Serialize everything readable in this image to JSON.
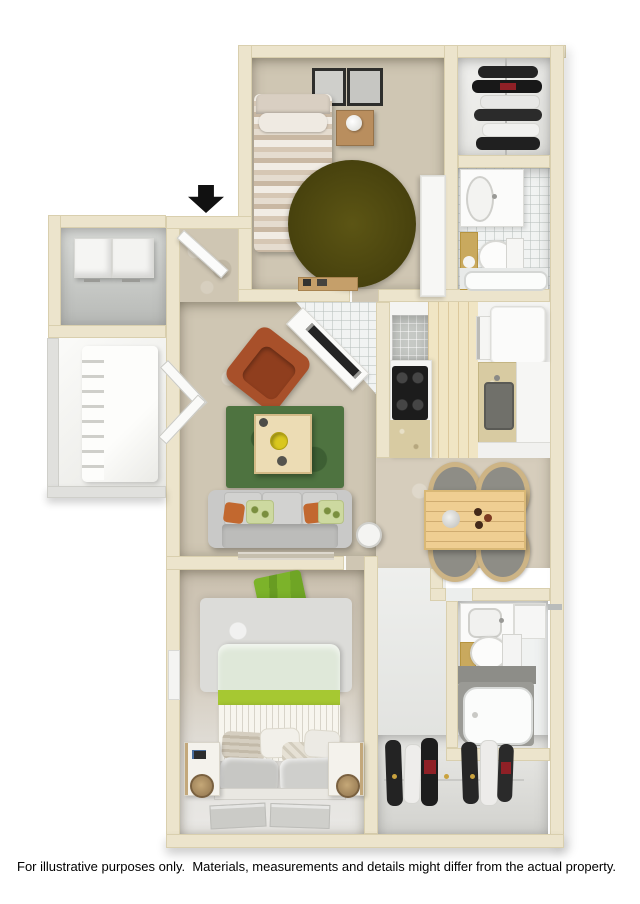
{
  "page": {
    "background": "#ffffff",
    "disclaimer": "For illustrative purposes only.  Materials, measurements and details might differ from the actual property."
  },
  "floorplan": {
    "description": "3D top-down floor plan of a two-bedroom, two-bathroom apartment",
    "entry_marker": "down-arrow",
    "rooms": [
      {
        "name": "bedroom-2",
        "furniture": [
          "twin-bed",
          "nightstand-with-lamp",
          "round-olive-rug",
          "two-wall-art-frames",
          "wardrobe",
          "small-shelf"
        ]
      },
      {
        "name": "closet-2",
        "furniture": [
          "hanging-clothes-rod"
        ]
      },
      {
        "name": "bathroom-2",
        "furniture": [
          "vanity-sink",
          "toilet",
          "bathtub",
          "tan-accent-panel"
        ]
      },
      {
        "name": "entry",
        "furniture": [
          "entry-door"
        ]
      },
      {
        "name": "storage-laundry",
        "furniture": [
          "washer",
          "dryer"
        ]
      },
      {
        "name": "patio",
        "furniture": [
          "lounge-chair"
        ]
      },
      {
        "name": "living-room",
        "furniture": [
          "orange-armchair",
          "green-area-rug",
          "coffee-table",
          "gray-sofa",
          "throw-pillows",
          "round-side-table",
          "corner-tv-console",
          "bay-window"
        ]
      },
      {
        "name": "kitchen",
        "furniture": [
          "range-cooktop",
          "refrigerator",
          "sink-counter",
          "wall-oven",
          "pantry"
        ]
      },
      {
        "name": "dining-area",
        "furniture": [
          "wood-dining-table",
          "four-wicker-chairs",
          "centerpiece",
          "cups"
        ]
      },
      {
        "name": "hallway",
        "furniture": []
      },
      {
        "name": "bathroom-1",
        "furniture": [
          "vanity-sink",
          "toilet",
          "bathtub",
          "tan-accent-panel"
        ]
      },
      {
        "name": "closet-1",
        "furniture": [
          "hanging-clothes-rod"
        ]
      },
      {
        "name": "bedroom-1",
        "furniture": [
          "queen-bed",
          "two-nightstands",
          "wood-table-lamps",
          "gray-shag-rug",
          "green-throw",
          "foot-mats",
          "wall-picture"
        ]
      }
    ],
    "colors": {
      "wall": "#ece4cc",
      "wall-edge": "#d9cfae",
      "carpet": "#cfc6b3",
      "carpet-light": "#d6cdbc",
      "white-floor": "#f1f2f0",
      "tile-cream": "#f0e5c4",
      "tile-gray": "#c6c9c5",
      "patio-wall": "#e0e0dd",
      "rug-olive": "#4d470e",
      "rug-green": "#4e7340",
      "rug-gray": "#dcdcd9",
      "sofa-gray": "#c9c9c8",
      "chair-orange": "#a8502a",
      "wood-light": "#ecdcb4",
      "dining-wood": "#efce92",
      "bed-sage": "#dfe8d9",
      "bed-green": "#a6c832",
      "bed-white": "#f7f5ee",
      "counter-tan": "#d8cba2",
      "appliance-black": "#1c1c1c",
      "accent-tan": "#c9a95e",
      "cloth-dark": "#232323",
      "cloth-red": "#8f2026",
      "arrow": "#111111",
      "text": "#000000"
    }
  }
}
